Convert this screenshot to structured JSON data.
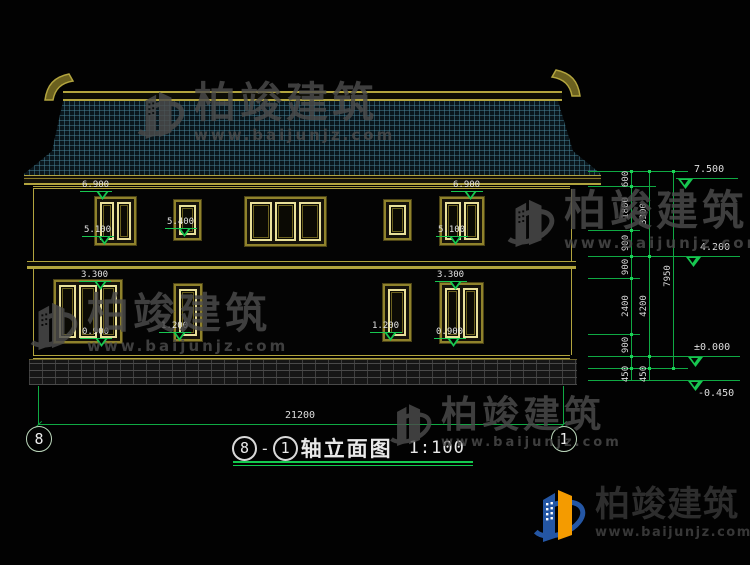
{
  "title": {
    "axis_a": "8",
    "sep": "-",
    "axis_b": "1",
    "name": "轴立面图",
    "scale": "1:100"
  },
  "axis_bubbles": {
    "left": "8",
    "right": "1"
  },
  "dimensions": {
    "total_width": "21200",
    "chain_inner": [
      "600",
      "1800",
      "900",
      "900",
      "2400",
      "900",
      "450"
    ],
    "chain_middle": [
      "3300",
      "4200",
      "450"
    ],
    "chain_outer": [
      "7950"
    ],
    "elevations": [
      "7.500",
      "4.200",
      "±0.000",
      "-0.450"
    ]
  },
  "annotations": {
    "levels": [
      "6.900",
      "5.100",
      "5.400",
      "6.900",
      "5.100",
      "3.300",
      "0.900",
      "1.200",
      "1.200",
      "3.300",
      "0.900"
    ]
  },
  "watermark": {
    "brand": "柏竣建筑",
    "website": "www.baijunjz.com"
  },
  "footer_logo": {
    "brand": "柏竣建筑",
    "website": "www.baijunjz.com"
  }
}
